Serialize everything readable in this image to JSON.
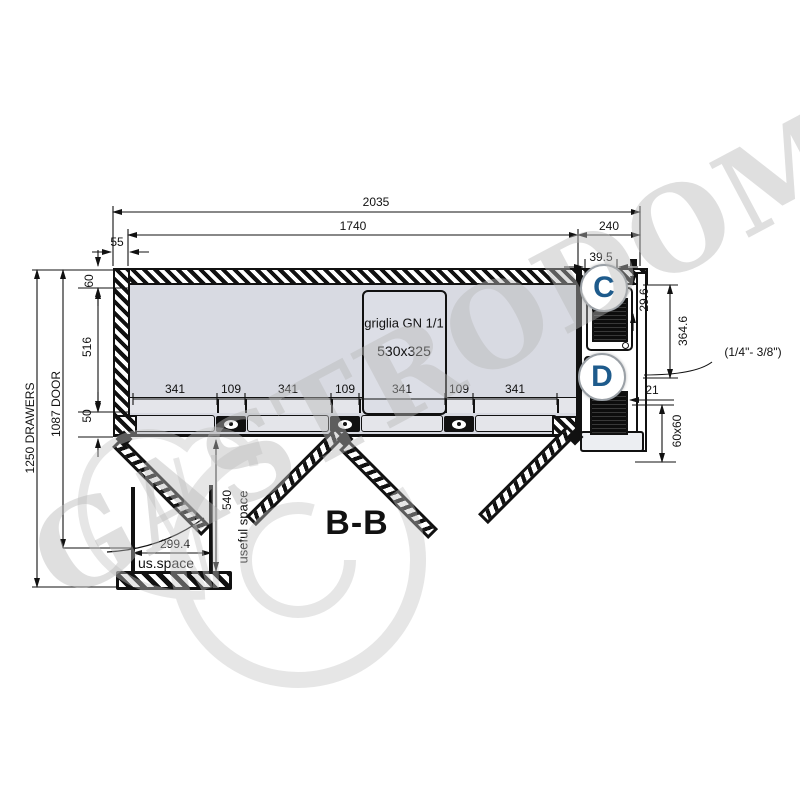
{
  "section_label": "B-B",
  "watermark": "GASTRODOMUS",
  "callouts": {
    "c": "C",
    "d": "D"
  },
  "grid_box": {
    "line1": "griglia GN 1/1",
    "line2": "530x325"
  },
  "colors": {
    "callout_letter": "#1e5b8c",
    "interior_fill": "#d8dae2",
    "line": "#111111",
    "watermark": "#b9b9b9"
  },
  "dimensions": {
    "overall_width": "2035",
    "interior_width": "1740",
    "motor_width": "240",
    "wall_left": "55",
    "cond_offset": "39.5",
    "cond_inset": "29.6",
    "motor_height": "364.6",
    "cond_gap": "21",
    "cond_section": "60x60",
    "pipe_note": "(1/4\"- 3/8\")",
    "depth_drawers": "1250 DRAWERS",
    "depth_door": "1087 DOOR",
    "top_thickness": "60",
    "interior_depth": "516",
    "front_thickness": "50",
    "bay_widths": [
      "341",
      "109",
      "341",
      "109",
      "341",
      "109",
      "341"
    ],
    "drawer_width": "299.4",
    "drawer_width_label": "us.space",
    "drawer_depth": "540",
    "drawer_depth_label": "useful space"
  }
}
